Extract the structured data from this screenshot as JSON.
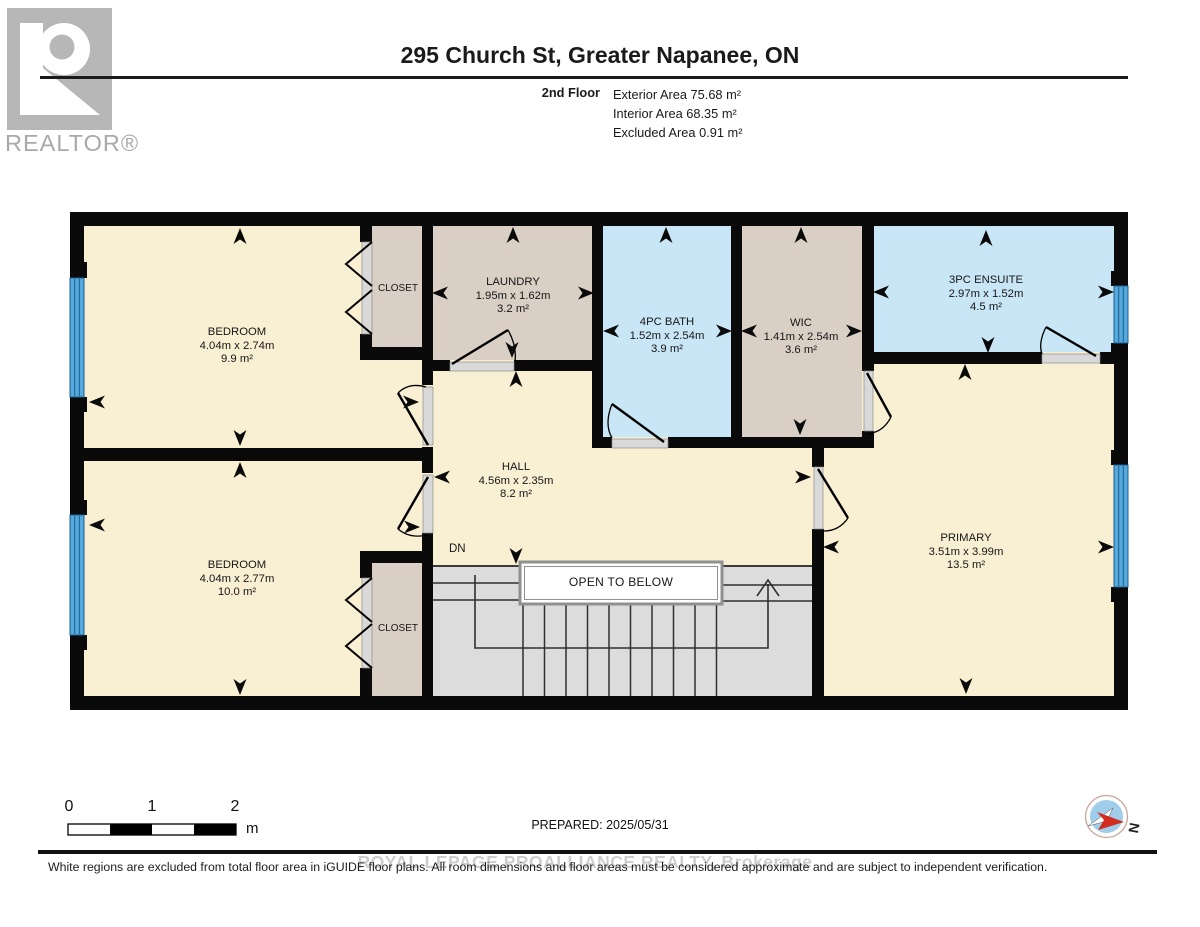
{
  "header": {
    "logo_text": "REALTOR®",
    "title": "295 Church St, Greater Napanee, ON",
    "floor_label": "2nd Floor",
    "areas": [
      "Exterior Area 75.68 m²",
      "Interior Area 68.35 m²",
      "Excluded Area 0.91 m²"
    ]
  },
  "plan": {
    "rooms": [
      {
        "name": "BEDROOM",
        "dims": "4.04m x 2.74m",
        "area": "9.9 m²"
      },
      {
        "name": "CLOSET"
      },
      {
        "name": "LAUNDRY",
        "dims": "1.95m x 1.62m",
        "area": "3.2 m²"
      },
      {
        "name": "4PC BATH",
        "dims": "1.52m x 2.54m",
        "area": "3.9 m²"
      },
      {
        "name": "WIC",
        "dims": "1.41m x 2.54m",
        "area": "3.6 m²"
      },
      {
        "name": "3PC ENSUITE",
        "dims": "2.97m x 1.52m",
        "area": "4.5 m²"
      },
      {
        "name": "HALL",
        "dims": "4.56m x 2.35m",
        "area": "8.2 m²"
      },
      {
        "name": "PRIMARY",
        "dims": "3.51m x 3.99m",
        "area": "13.5 m²"
      },
      {
        "name": "BEDROOM",
        "dims": "4.04m x 2.77m",
        "area": "10.0 m²"
      },
      {
        "name": "CLOSET"
      }
    ],
    "stairs": {
      "down_label": "DN",
      "open_label": "OPEN TO BELOW"
    }
  },
  "footer": {
    "scale": {
      "ticks": [
        "0",
        "1",
        "2"
      ],
      "unit": "m"
    },
    "prepared": "PREPARED: 2025/05/31",
    "compass_label": "N",
    "watermark": "ROYAL LEPAGE PROALLIANCE REALTY, Brokerage",
    "disclaimer": "White regions are excluded from total floor area in iGUIDE floor plans. All room dimensions and floor areas must be considered approximate and are subject to independent verification."
  },
  "colors": {
    "wall": "#0a0a0a",
    "room_cream": "#f9efd2",
    "closet_tan": "#d9cfc4",
    "bath_blue": "#c9e6f7",
    "stairs_gray": "#dcdcdc",
    "window_blue": "#55a9dc",
    "compass_needle_red": "#d22b1f"
  }
}
